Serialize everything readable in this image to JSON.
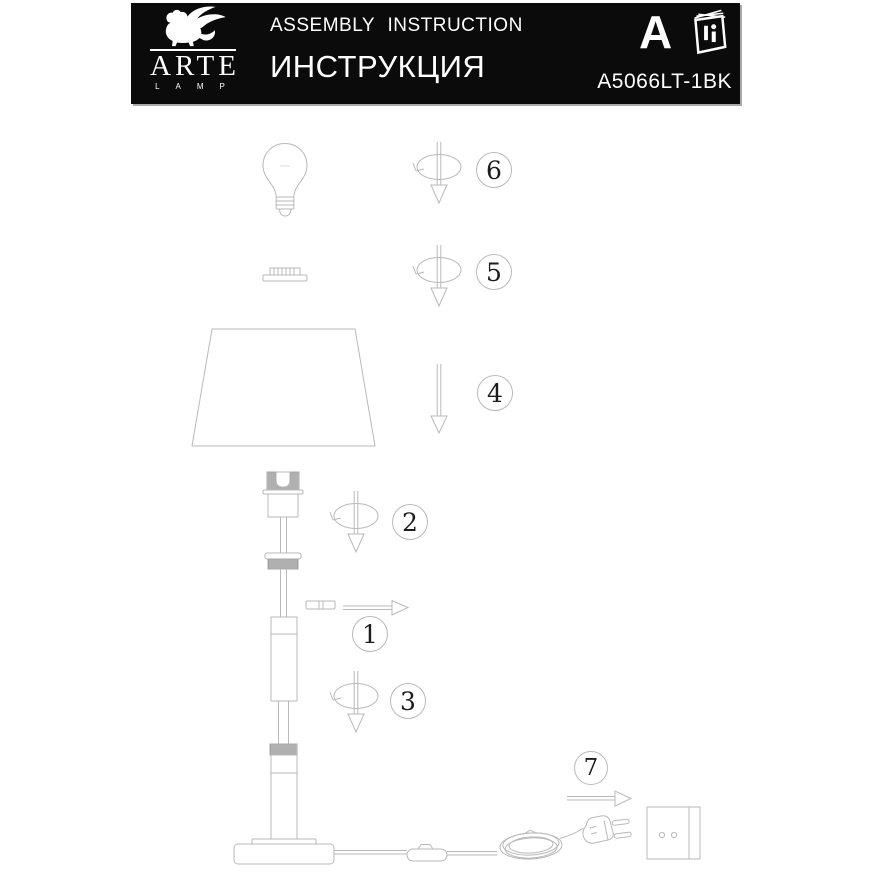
{
  "header": {
    "brand": "ARTE",
    "brand_sub": "LAMP",
    "title_en": "ASSEMBLY INSTRUCTION",
    "title_ru": "ИНСТРУКЦИЯ",
    "corner_letter": "A",
    "model": "A5066LT-1BK"
  },
  "steps": [
    {
      "label": "1"
    },
    {
      "label": "2"
    },
    {
      "label": "3"
    },
    {
      "label": "4"
    },
    {
      "label": "5"
    },
    {
      "label": "6"
    },
    {
      "label": "7"
    }
  ],
  "icons": {
    "logo": "winged-lion",
    "manual": "instruction-booklet",
    "rotate": "rotate-screw-arrow",
    "down": "down-arrow",
    "right": "right-arrow"
  },
  "colors": {
    "page_bg": "#ffffff",
    "header_bg": "#0b0b0b",
    "header_text": "#ffffff",
    "line": "#b9b9b9",
    "line_dark": "#9b9b9b",
    "digit": "#1c1c1c"
  }
}
